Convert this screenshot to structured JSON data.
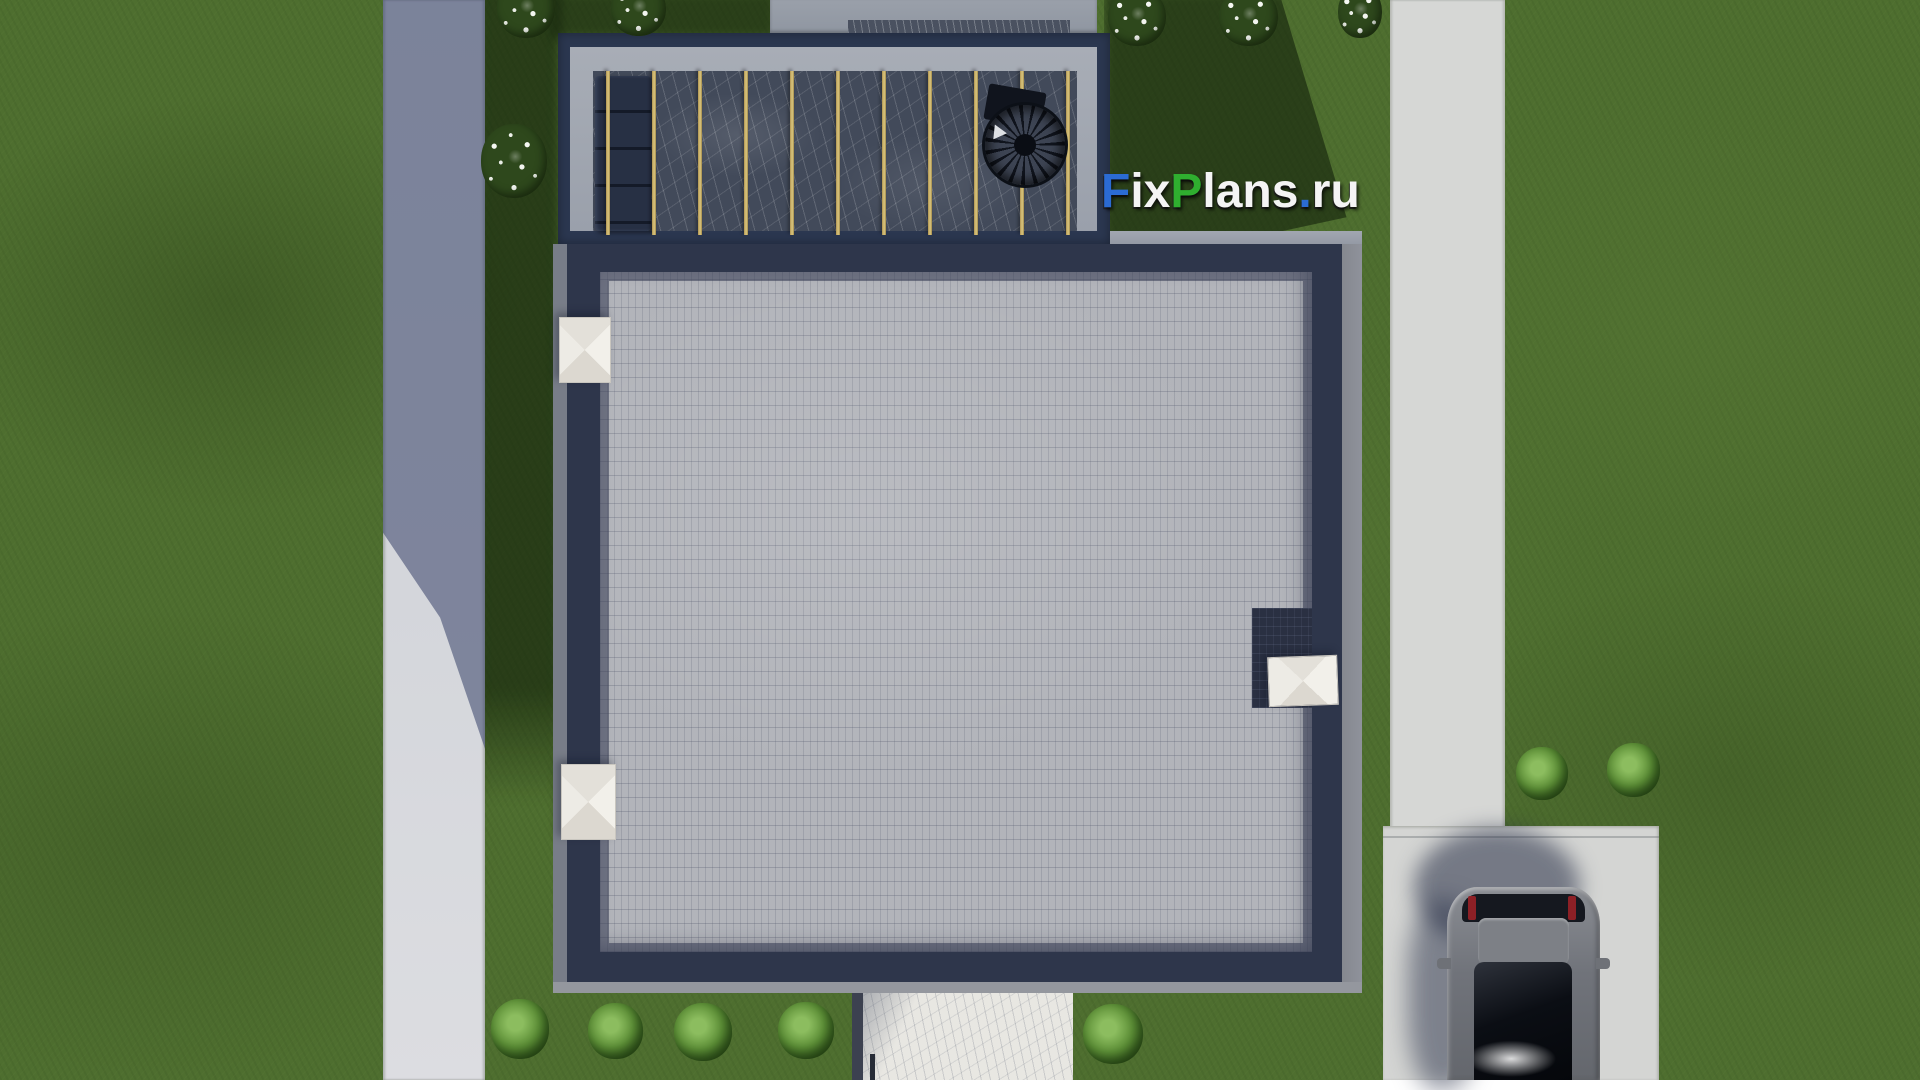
{
  "watermark": {
    "text": "FixPlans.ru",
    "segments": [
      {
        "text": "F",
        "color": "#2b6bd3"
      },
      {
        "text": "ix",
        "color": "#f4f4f4"
      },
      {
        "text": "P",
        "color": "#2fae2f"
      },
      {
        "text": "lans",
        "color": "#f4f4f4"
      },
      {
        "text": ".",
        "color": "#2b6bd3"
      },
      {
        "text": "ru",
        "color": "#f4f4f4"
      }
    ]
  },
  "scene": {
    "type": "3d-aerial-architectural-render",
    "view": "top-down roof plan of a modern flat-roof house with roof terrace",
    "elements": [
      "lawn",
      "left-footpath",
      "right-road",
      "driveway",
      "parked-car",
      "flat-roof-paver-field",
      "roof-parapet",
      "roof-terrace-with-pergola",
      "spiral-staircase",
      "outdoor-sofa",
      "roof-skylights",
      "roof-alcove",
      "marble-walkway",
      "garden-bushes",
      "white-flower-bushes",
      "upper-platform"
    ],
    "counts": {
      "pergola_beams": 11,
      "skylights": 3,
      "green_bushes": 7,
      "flower_bushes": 6,
      "cars": 1
    },
    "palette": {
      "grass": "#4e6e2f",
      "grass_shadow": "#24380f",
      "path_light": "#d5d7db",
      "path_shadow": "#7e87a2",
      "road": "#d6d7d5",
      "roof_pavers": "#b2b4ba",
      "parapet_navy": "#2e364b",
      "terrace_frame_navy": "#2b3750",
      "concrete_band": "#9fa5b0",
      "terrace_marble": "#424a5a",
      "pergola_beam_gold": "#d2ba74",
      "skylight_white": "#f1efe9",
      "car_body": "#7d8086",
      "car_glass": "#0c0f15",
      "taillight_red": "#8d2026"
    }
  },
  "pergola": {
    "beam_count": 11
  }
}
